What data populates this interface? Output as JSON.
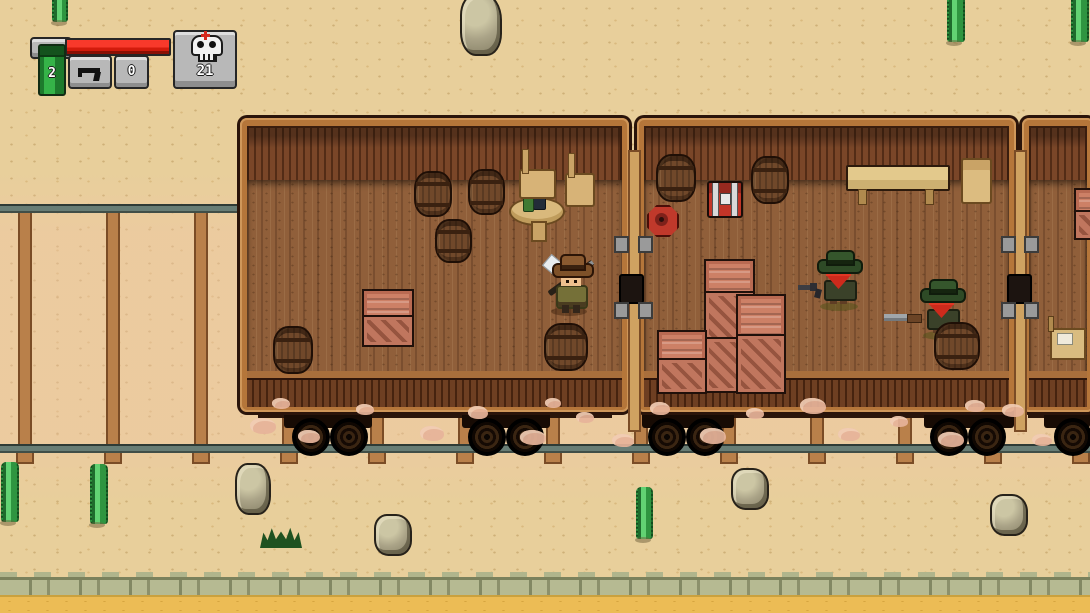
{
  "meta": {
    "app": "pixel-art western train game",
    "view": "top-down desert railroad with three boxcars"
  },
  "hud": {
    "dynamite_slot": {
      "icon": "dynamite-stick-icon",
      "count": "2",
      "stick_color": "#35b348"
    },
    "health_bar": {
      "fill_pct": 100,
      "fill_color": "#f0281a"
    },
    "weapon_slot": {
      "icon": "pistol-icon",
      "ammo": "0"
    },
    "kill_counter": {
      "icon": "skull-icon",
      "count": "21",
      "cross_color": "#d6281e"
    }
  },
  "palette": {
    "sand": "#e8cf9b",
    "lower_sand": "#ecbc55",
    "ledge_stone": "#b6ba92",
    "rail": "#687d75",
    "tie_wood": "#b9804a",
    "car_frame": "#b5763a",
    "car_wall_dark": "#5d3721",
    "car_floor": "#905f3a",
    "crate": "#cd8066",
    "barrel": "#70482a",
    "enemy_hat": "#2e4a26",
    "enemy_bandana": "#cd2a1c",
    "player_shirt": "#757038"
  },
  "scene": {
    "entities_summary": {
      "player": 1,
      "enemies": 2,
      "train_cars": 3,
      "barrels": 8,
      "crates": 6,
      "rocks": 5,
      "cacti": 6,
      "chest": 1,
      "mine": 1
    },
    "sprites": {
      "back": [
        {
          "t": "tie",
          "x": 18,
          "y": 206,
          "w": 10,
          "h": 238
        },
        {
          "t": "tie",
          "x": 106,
          "y": 206,
          "w": 10,
          "h": 238
        },
        {
          "t": "tie",
          "x": 194,
          "y": 206,
          "w": 10,
          "h": 238
        },
        {
          "t": "tie",
          "x": 282,
          "y": 206,
          "w": 10,
          "h": 238
        },
        {
          "t": "tie",
          "x": 370,
          "y": 206,
          "w": 10,
          "h": 238
        },
        {
          "t": "tie",
          "x": 458,
          "y": 206,
          "w": 10,
          "h": 238
        },
        {
          "t": "tie",
          "x": 546,
          "y": 206,
          "w": 10,
          "h": 238
        },
        {
          "t": "tie",
          "x": 634,
          "y": 206,
          "w": 10,
          "h": 238
        },
        {
          "t": "tie",
          "x": 722,
          "y": 206,
          "w": 10,
          "h": 238
        },
        {
          "t": "tie",
          "x": 810,
          "y": 206,
          "w": 10,
          "h": 238
        },
        {
          "t": "tie",
          "x": 898,
          "y": 206,
          "w": 10,
          "h": 238
        },
        {
          "t": "tie",
          "x": 986,
          "y": 206,
          "w": 10,
          "h": 238
        },
        {
          "t": "tie",
          "x": 1074,
          "y": 206,
          "w": 10,
          "h": 238
        },
        {
          "t": "tab",
          "x": 16,
          "y": 451,
          "w": 14,
          "h": 9
        },
        {
          "t": "tab",
          "x": 104,
          "y": 451,
          "w": 14,
          "h": 9
        },
        {
          "t": "tab",
          "x": 192,
          "y": 451,
          "w": 14,
          "h": 9
        },
        {
          "t": "tab",
          "x": 280,
          "y": 451,
          "w": 14,
          "h": 9
        },
        {
          "t": "tab",
          "x": 368,
          "y": 451,
          "w": 14,
          "h": 9
        },
        {
          "t": "tab",
          "x": 456,
          "y": 451,
          "w": 14,
          "h": 9
        },
        {
          "t": "tab",
          "x": 544,
          "y": 451,
          "w": 14,
          "h": 9
        },
        {
          "t": "tab",
          "x": 632,
          "y": 451,
          "w": 14,
          "h": 9
        },
        {
          "t": "tab",
          "x": 720,
          "y": 451,
          "w": 14,
          "h": 9
        },
        {
          "t": "tab",
          "x": 808,
          "y": 451,
          "w": 14,
          "h": 9
        },
        {
          "t": "tab",
          "x": 896,
          "y": 451,
          "w": 14,
          "h": 9
        },
        {
          "t": "tab",
          "x": 984,
          "y": 451,
          "w": 14,
          "h": 9
        },
        {
          "t": "tab",
          "x": 1072,
          "y": 451,
          "w": 14,
          "h": 9
        },
        {
          "t": "rock",
          "x": 460,
          "y": -6,
          "w": 38,
          "h": 58
        },
        {
          "t": "rock",
          "x": 235,
          "y": 463,
          "w": 32,
          "h": 48
        },
        {
          "t": "rock",
          "x": 731,
          "y": 468,
          "w": 34,
          "h": 38
        },
        {
          "t": "rock",
          "x": 374,
          "y": 514,
          "w": 34,
          "h": 38
        },
        {
          "t": "rock",
          "x": 990,
          "y": 494,
          "w": 34,
          "h": 38
        },
        {
          "t": "cactus",
          "x": 52,
          "y": -18,
          "w": 12,
          "h": 40
        },
        {
          "t": "cactus",
          "x": 947,
          "y": -8,
          "w": 14,
          "h": 50
        },
        {
          "t": "cactus",
          "x": 1071,
          "y": -6,
          "w": 14,
          "h": 48
        },
        {
          "t": "cactus",
          "x": 1,
          "y": 462,
          "w": 14,
          "h": 60
        },
        {
          "t": "cactus",
          "x": 90,
          "y": 464,
          "w": 14,
          "h": 60
        },
        {
          "t": "cactus",
          "x": 636,
          "y": 487,
          "w": 13,
          "h": 52
        },
        {
          "t": "grass",
          "x": 260,
          "y": 526,
          "w": 42,
          "h": 22
        }
      ],
      "under": [
        {
          "t": "beam",
          "x": 258,
          "y": 404,
          "w": 354,
          "h": 14
        },
        {
          "t": "beam",
          "x": 652,
          "y": 404,
          "w": 348,
          "h": 14
        },
        {
          "t": "beam",
          "x": 1028,
          "y": 404,
          "w": 62,
          "h": 14
        },
        {
          "t": "bog",
          "x": 284,
          "y": 410,
          "w": 88,
          "h": 18
        },
        {
          "t": "bog",
          "x": 462,
          "y": 410,
          "w": 88,
          "h": 18
        },
        {
          "t": "bog",
          "x": 642,
          "y": 410,
          "w": 92,
          "h": 18
        },
        {
          "t": "bog",
          "x": 924,
          "y": 410,
          "w": 90,
          "h": 18
        },
        {
          "t": "bog",
          "x": 1044,
          "y": 410,
          "w": 46,
          "h": 18
        },
        {
          "t": "wheel",
          "x": 292,
          "y": 418,
          "w": 34,
          "h": 34
        },
        {
          "t": "wheel",
          "x": 330,
          "y": 418,
          "w": 34,
          "h": 34
        },
        {
          "t": "wheel",
          "x": 468,
          "y": 418,
          "w": 34,
          "h": 34
        },
        {
          "t": "wheel",
          "x": 506,
          "y": 418,
          "w": 34,
          "h": 34
        },
        {
          "t": "wheel",
          "x": 648,
          "y": 418,
          "w": 34,
          "h": 34
        },
        {
          "t": "wheel",
          "x": 686,
          "y": 418,
          "w": 34,
          "h": 34
        },
        {
          "t": "wheel",
          "x": 930,
          "y": 418,
          "w": 34,
          "h": 34
        },
        {
          "t": "wheel",
          "x": 968,
          "y": 418,
          "w": 34,
          "h": 34
        },
        {
          "t": "wheel",
          "x": 1054,
          "y": 418,
          "w": 34,
          "h": 34
        }
      ],
      "mid": [
        {
          "t": "bridge",
          "x": 628,
          "y": 150,
          "w": 9,
          "h": 278
        },
        {
          "t": "bridge",
          "x": 1014,
          "y": 150,
          "w": 9,
          "h": 278
        },
        {
          "t": "coup",
          "x": 619,
          "y": 274,
          "w": 21,
          "h": 26
        },
        {
          "t": "coup",
          "x": 1007,
          "y": 274,
          "w": 21,
          "h": 26
        },
        {
          "t": "dpost",
          "x": 614,
          "y": 236,
          "w": 11,
          "h": 13
        },
        {
          "t": "dpost",
          "x": 614,
          "y": 302,
          "w": 11,
          "h": 13
        },
        {
          "t": "dpost",
          "x": 638,
          "y": 236,
          "w": 11,
          "h": 13
        },
        {
          "t": "dpost",
          "x": 638,
          "y": 302,
          "w": 11,
          "h": 13
        },
        {
          "t": "dpost",
          "x": 1001,
          "y": 236,
          "w": 11,
          "h": 13
        },
        {
          "t": "dpost",
          "x": 1001,
          "y": 302,
          "w": 11,
          "h": 13
        },
        {
          "t": "dpost",
          "x": 1024,
          "y": 236,
          "w": 11,
          "h": 13
        },
        {
          "t": "dpost",
          "x": 1024,
          "y": 302,
          "w": 11,
          "h": 13
        },
        {
          "t": "barrel",
          "x": 414,
          "y": 171,
          "w": 34,
          "h": 42
        },
        {
          "t": "barrel",
          "x": 468,
          "y": 169,
          "w": 33,
          "h": 42
        },
        {
          "t": "barrel",
          "x": 435,
          "y": 219,
          "w": 33,
          "h": 40
        },
        {
          "t": "barrel",
          "x": 273,
          "y": 326,
          "w": 36,
          "h": 44
        },
        {
          "t": "barrel",
          "x": 544,
          "y": 323,
          "w": 40,
          "h": 44
        },
        {
          "t": "barrel",
          "x": 656,
          "y": 154,
          "w": 36,
          "h": 44
        },
        {
          "t": "barrel",
          "x": 751,
          "y": 156,
          "w": 34,
          "h": 44
        },
        {
          "t": "crh",
          "x": 362,
          "y": 289,
          "w": 48,
          "h": 28
        },
        {
          "t": "crd",
          "x": 362,
          "y": 315,
          "w": 48,
          "h": 28
        },
        {
          "t": "crh",
          "x": 704,
          "y": 259,
          "w": 47,
          "h": 34
        },
        {
          "t": "crd",
          "x": 704,
          "y": 291,
          "w": 47,
          "h": 48
        },
        {
          "t": "crd",
          "x": 704,
          "y": 337,
          "w": 47,
          "h": 52
        },
        {
          "t": "crh",
          "x": 736,
          "y": 294,
          "w": 46,
          "h": 42
        },
        {
          "t": "crd",
          "x": 736,
          "y": 334,
          "w": 46,
          "h": 56
        },
        {
          "t": "crh",
          "x": 657,
          "y": 330,
          "w": 46,
          "h": 30
        },
        {
          "t": "crd",
          "x": 657,
          "y": 358,
          "w": 46,
          "h": 32
        },
        {
          "t": "crh",
          "x": 1074,
          "y": 188,
          "w": 34,
          "h": 24
        },
        {
          "t": "crd",
          "x": 1074,
          "y": 210,
          "w": 34,
          "h": 26
        }
      ],
      "front": [
        {
          "t": "barrel",
          "x": 934,
          "y": 322,
          "w": 42,
          "h": 44,
          "n": "barrel-front-of-enemy"
        },
        {
          "t": "dust",
          "x": 250,
          "y": 418,
          "w": 26,
          "h": 16
        },
        {
          "t": "dust",
          "x": 298,
          "y": 430,
          "w": 22,
          "h": 13
        },
        {
          "t": "dust",
          "x": 356,
          "y": 404,
          "w": 18,
          "h": 11
        },
        {
          "t": "dust",
          "x": 420,
          "y": 426,
          "w": 24,
          "h": 15
        },
        {
          "t": "dust",
          "x": 468,
          "y": 406,
          "w": 20,
          "h": 13
        },
        {
          "t": "dust",
          "x": 520,
          "y": 430,
          "w": 26,
          "h": 15
        },
        {
          "t": "dust",
          "x": 576,
          "y": 412,
          "w": 18,
          "h": 11
        },
        {
          "t": "dust",
          "x": 612,
          "y": 434,
          "w": 22,
          "h": 13
        },
        {
          "t": "dust",
          "x": 650,
          "y": 402,
          "w": 20,
          "h": 13
        },
        {
          "t": "dust",
          "x": 700,
          "y": 428,
          "w": 26,
          "h": 16
        },
        {
          "t": "dust",
          "x": 746,
          "y": 408,
          "w": 18,
          "h": 11
        },
        {
          "t": "dust",
          "x": 800,
          "y": 398,
          "w": 26,
          "h": 16
        },
        {
          "t": "dust",
          "x": 838,
          "y": 428,
          "w": 22,
          "h": 13
        },
        {
          "t": "dust",
          "x": 890,
          "y": 416,
          "w": 18,
          "h": 11
        },
        {
          "t": "dust",
          "x": 938,
          "y": 432,
          "w": 26,
          "h": 15
        },
        {
          "t": "dust",
          "x": 1002,
          "y": 404,
          "w": 22,
          "h": 13
        },
        {
          "t": "dust",
          "x": 1032,
          "y": 434,
          "w": 20,
          "h": 12
        },
        {
          "t": "dust",
          "x": 272,
          "y": 398,
          "w": 18,
          "h": 11
        },
        {
          "t": "dust",
          "x": 545,
          "y": 398,
          "w": 16,
          "h": 10
        },
        {
          "t": "dust",
          "x": 965,
          "y": 400,
          "w": 20,
          "h": 12
        }
      ]
    }
  }
}
